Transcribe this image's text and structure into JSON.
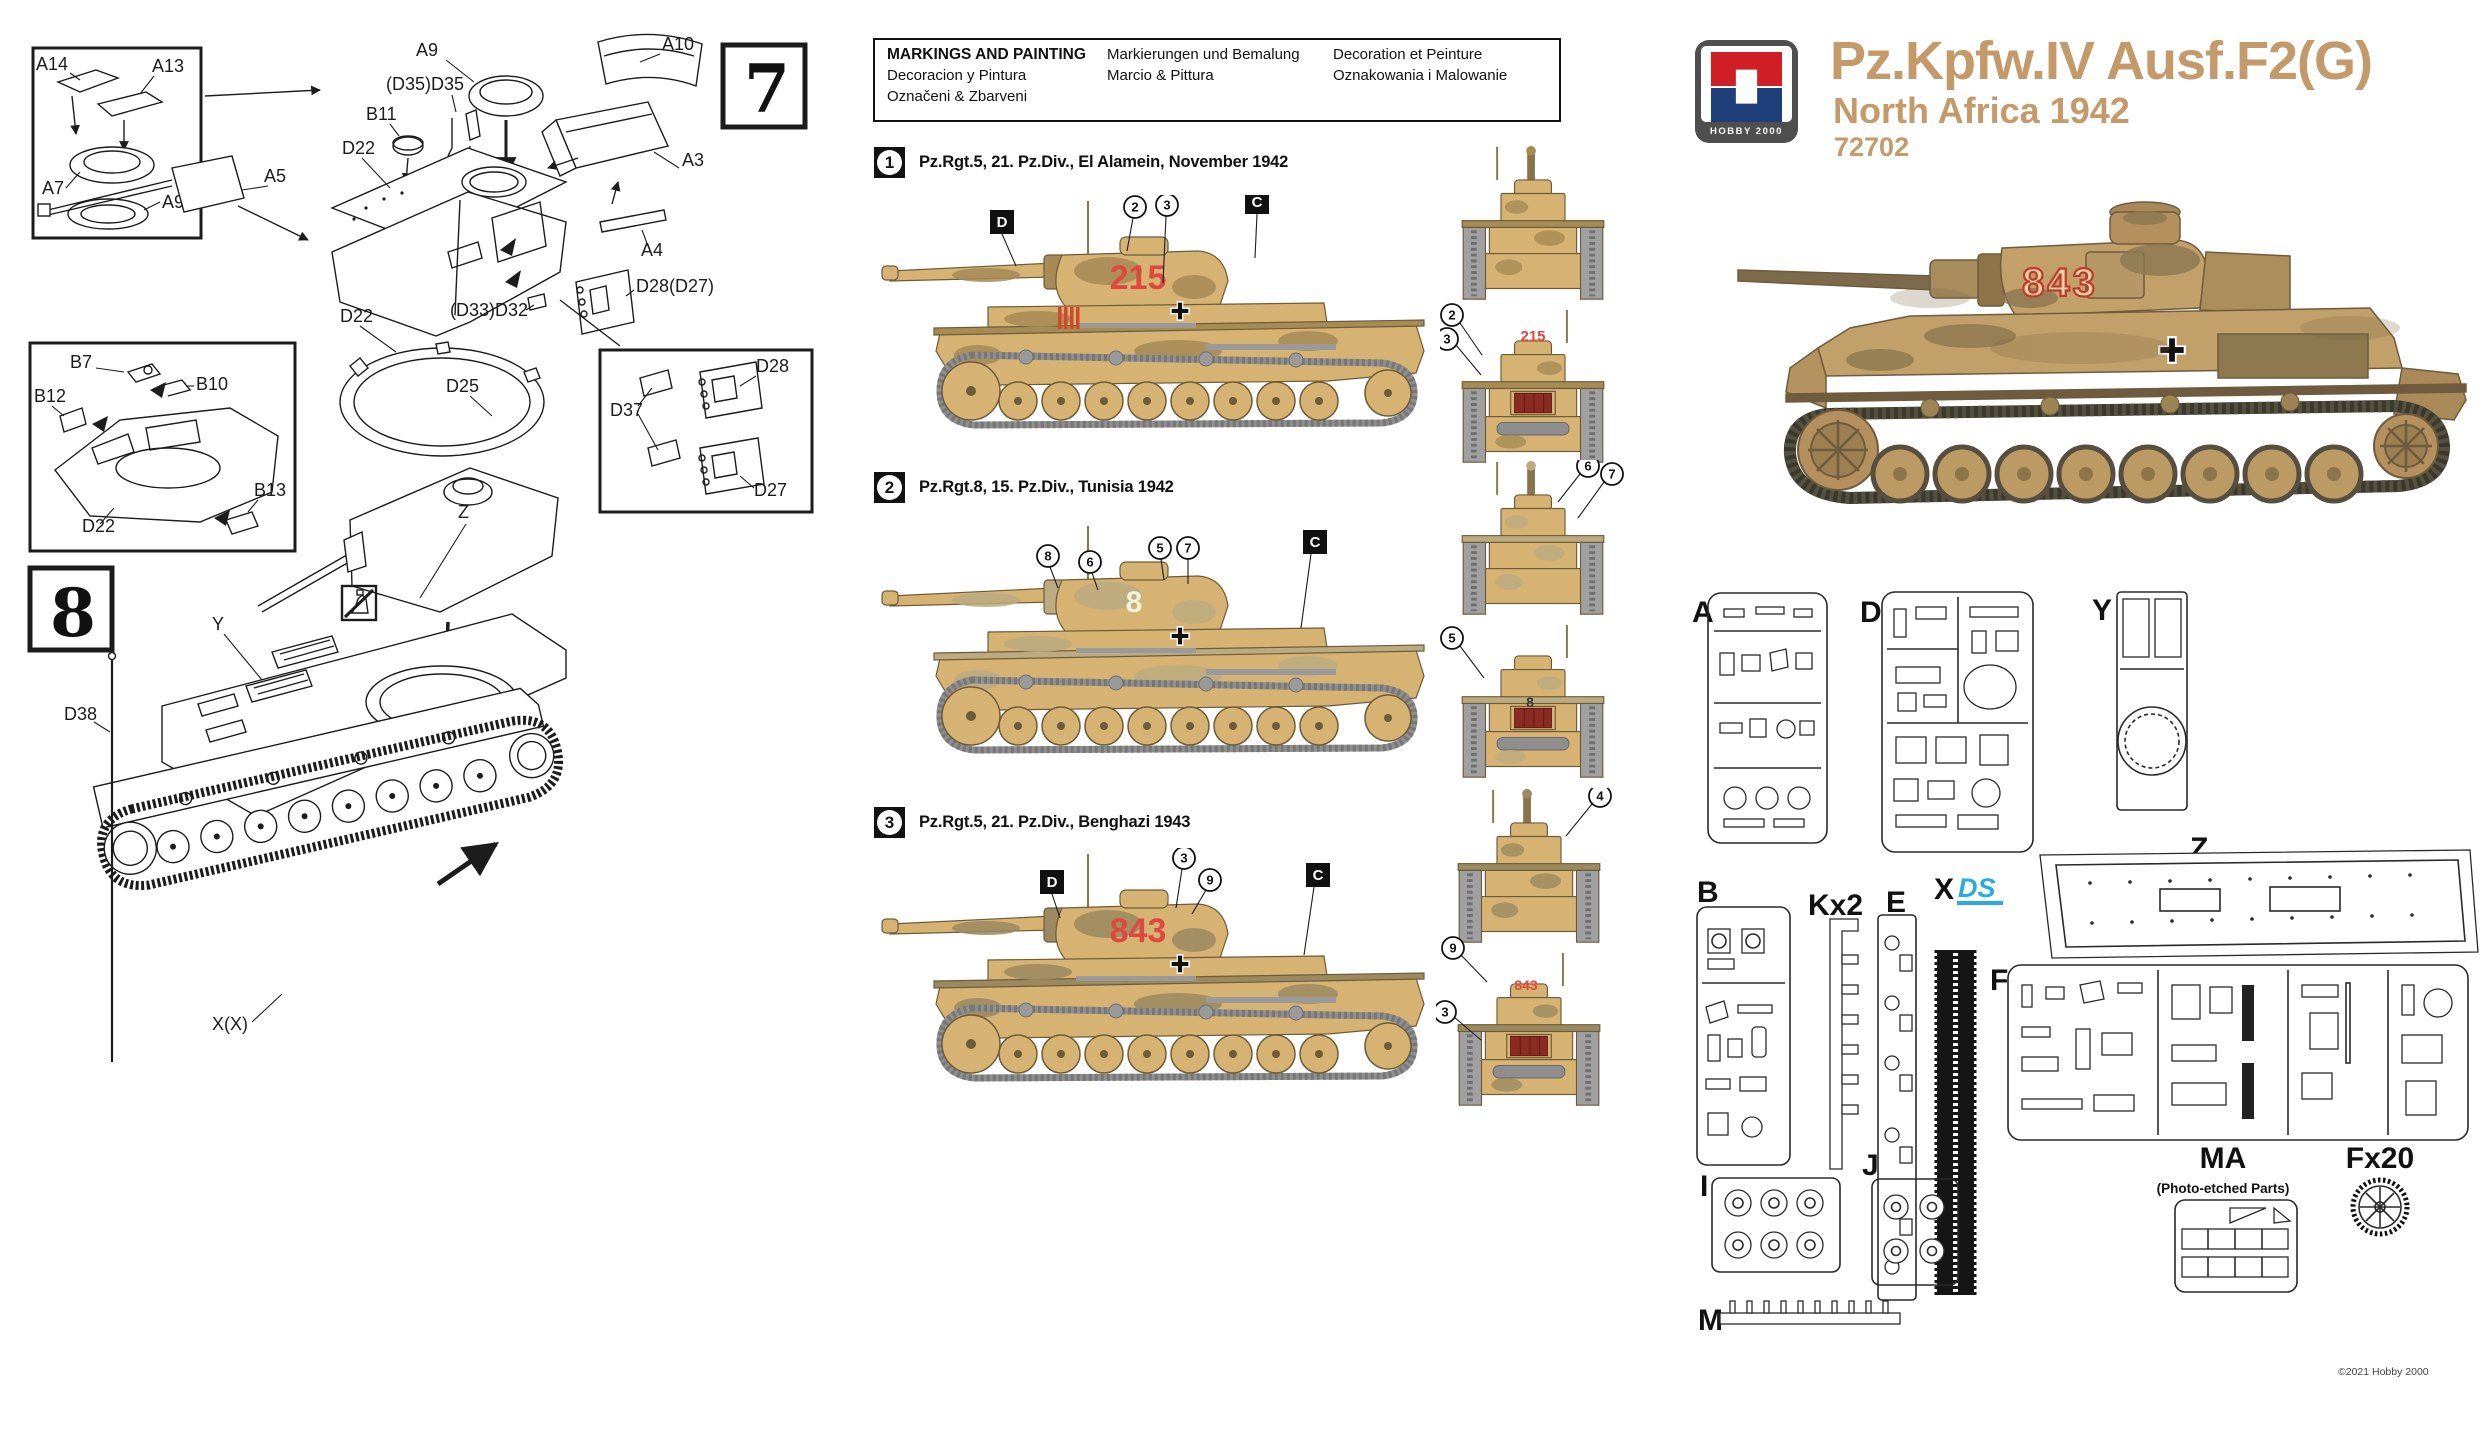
{
  "product": {
    "brand": "HOBBY 2000",
    "title": "Pz.Kpfw.IV Ausf.F2(G)",
    "subtitle": "North Africa 1942",
    "kit_number": "72702",
    "profile_turret_number": "843",
    "copyright": "©2021 Hobby 2000"
  },
  "markings_header": {
    "en": "MARKINGS AND PAINTING",
    "es": "Decoracion y Pintura",
    "cs": "Označeni & Zbarveni",
    "de": "Markierungen und Bemalung",
    "it": "Marcio & Pittura",
    "fr": "Decoration et Peinture",
    "pl": "Oznakowania i Malowanie"
  },
  "schemes": [
    {
      "badge": "1",
      "title": "Pz.Rgt.5, 21. Pz.Div., El Alamein, November 1942",
      "turret_number": "215",
      "rear_number": "215",
      "callout_d": "D",
      "callout_c": "C",
      "callout_1": "2",
      "callout_2": "3",
      "rear_callout_1": "2",
      "rear_callout_2": "3"
    },
    {
      "badge": "2",
      "title": "Pz.Rgt.8, 15. Pz.Div., Tunisia 1942",
      "turret_number": "8",
      "rear_number": "8",
      "callout_c": "C",
      "callout_1": "8",
      "callout_2": "6",
      "callout_3": "5",
      "callout_4": "7",
      "front_callout_1": "6",
      "front_callout_2": "7",
      "rear_callout_1": "5"
    },
    {
      "badge": "3",
      "title": "Pz.Rgt.5, 21. Pz.Div., Benghazi 1943",
      "turret_number": "843",
      "rear_number": "843",
      "callout_d": "D",
      "callout_c": "C",
      "callout_1": "3",
      "callout_2": "9",
      "front_callout_1": "4",
      "rear_callout_1": "9",
      "rear_callout_2": "3"
    }
  ],
  "step7": {
    "number": "7",
    "labels": {
      "a14": "A14",
      "a13": "A13",
      "a7": "A7",
      "a9_inset": "A9",
      "a9": "A9",
      "d35": "(D35)D35",
      "b11": "B11",
      "d22_roof": "D22",
      "a5": "A5",
      "a10": "A10",
      "a3": "A3",
      "a4": "A4",
      "d28_d27": "D28(D27)",
      "d33_d32": "(D33)D32",
      "d25": "D25",
      "b7": "B7",
      "b10": "B10",
      "b12": "B12",
      "b13": "B13",
      "d22_shell": "D22",
      "d37": "D37",
      "d28": "D28",
      "d27": "D27"
    }
  },
  "step8": {
    "number": "8",
    "labels": {
      "d22": "D22",
      "y": "Y",
      "d38": "D38",
      "z": "Z",
      "x": "X(X)"
    }
  },
  "sprues": {
    "a": "A",
    "d": "D",
    "y": "Y",
    "b": "B",
    "k": "Kx2",
    "e": "E",
    "x": "X",
    "ds": "DS",
    "z": "Z",
    "f": "F",
    "i": "I",
    "j": "J",
    "m": "M",
    "ma": "MA",
    "ma_note": "(Photo-etched Parts)",
    "fx": "Fx20"
  },
  "colors": {
    "title_tan": "#c49a6b",
    "marking_red": "#e0473f",
    "ds_blue": "#29abe2",
    "sand_base": "#d6b273",
    "camo_brown": "#a68b55"
  }
}
